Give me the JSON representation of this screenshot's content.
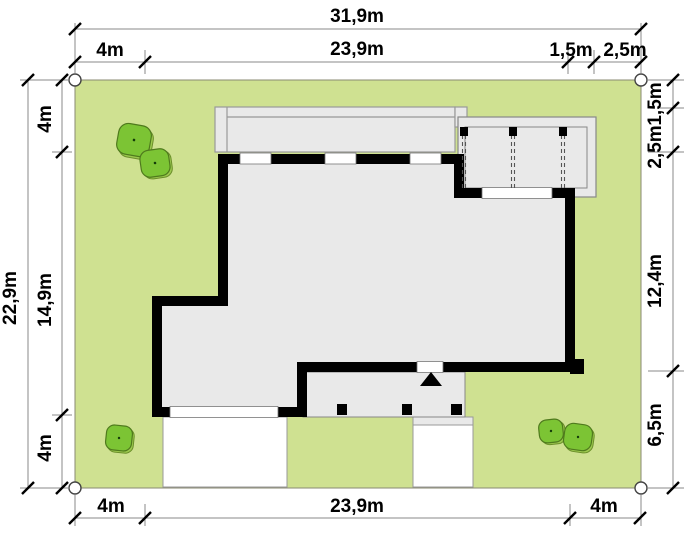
{
  "plan": {
    "title": "house-site-plan",
    "dimensions": {
      "top_total": "31,9m",
      "top_left": "4m",
      "top_center": "23,9m",
      "top_seg1": "1,5m",
      "top_seg2": "2,5m",
      "bottom_left": "4m",
      "bottom_center": "23,9m",
      "bottom_right": "4m",
      "left_total": "22,9m",
      "left_top": "4m",
      "left_middle": "14,9m",
      "left_bottom": "4m",
      "right_top": "1,5m",
      "right_upper": "2,5m",
      "right_middle": "12,4m",
      "right_lower": "6,5m"
    },
    "features": {
      "lawn": "plot lawn",
      "house": "house footprint",
      "carport": "carport / pergola with roof beams",
      "roof_band": "upper floor overhang",
      "porch": "covered entrance terrace",
      "entrance_marker": "entrance arrow",
      "driveway": "driveway paving",
      "walkway": "entrance walkway",
      "trees": "garden trees"
    },
    "colors": {
      "lawn": "#cfe191",
      "house_fill": "#e9e9e9",
      "wall": "#000000",
      "tree_fill": "#7cc434",
      "tree_outline": "#4f7a1d",
      "paving": "#ffffff",
      "dim_line": "#8a8a8a"
    }
  }
}
